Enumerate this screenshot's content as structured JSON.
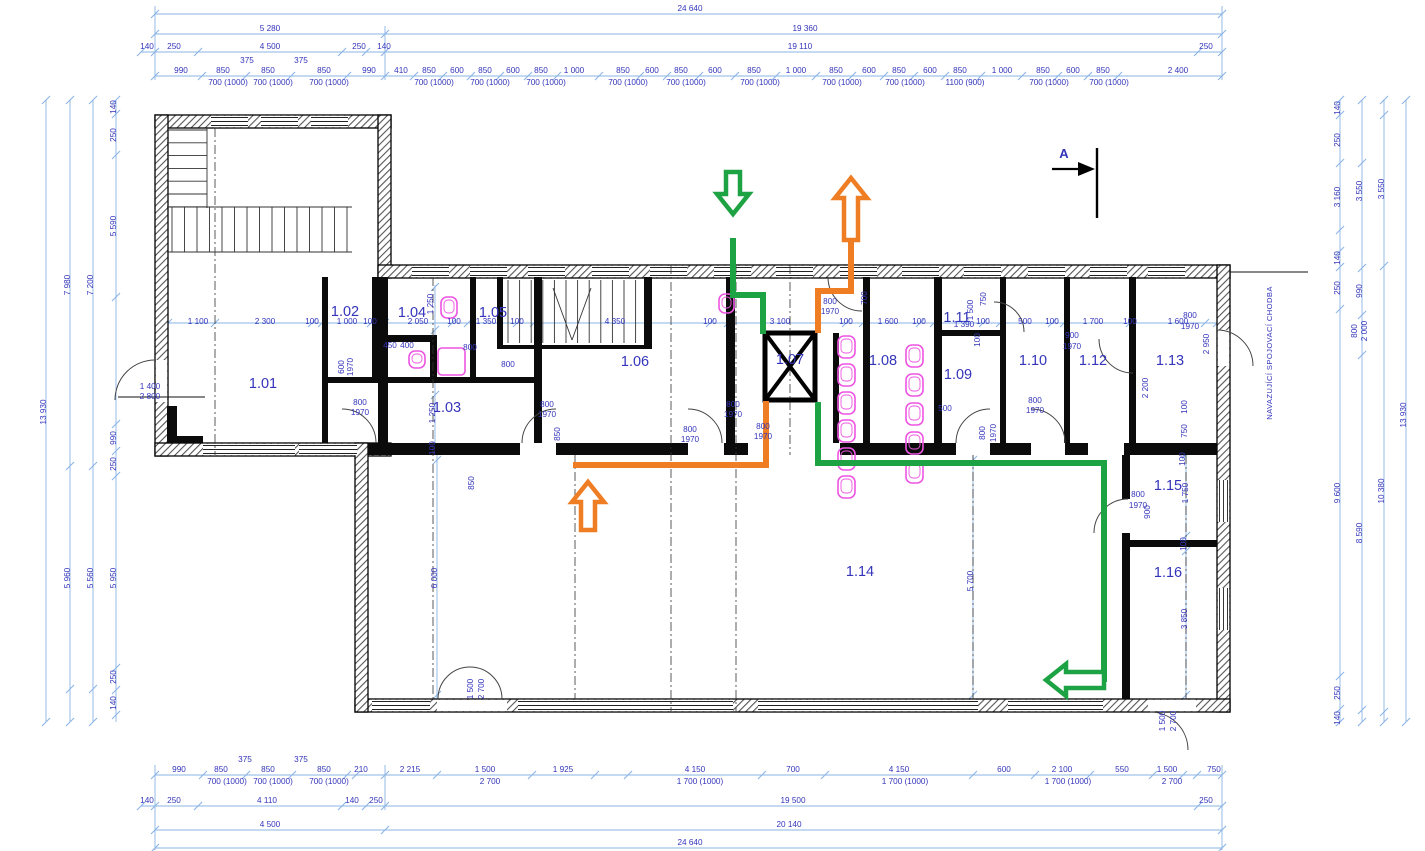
{
  "drawing": {
    "type": "architectural-floor-plan",
    "section_marker": "A",
    "corridor_note": "NAVAZUJÍCÍ SPOJOVACÍ CHODBA"
  },
  "colors": {
    "dim_line": "#8ab4e4",
    "dim_text": "#3434bb",
    "room_text": "#3434bb",
    "wall": "#000000",
    "fixture": "#ee55e2",
    "green": "#1da344",
    "orange": "#ee7d23"
  },
  "rooms": [
    {
      "id": "1.01",
      "x": 263,
      "y": 388
    },
    {
      "id": "1.02",
      "x": 345,
      "y": 316
    },
    {
      "id": "1.03",
      "x": 447,
      "y": 412
    },
    {
      "id": "1.04",
      "x": 412,
      "y": 317
    },
    {
      "id": "1.05",
      "x": 493,
      "y": 317
    },
    {
      "id": "1.06",
      "x": 635,
      "y": 366
    },
    {
      "id": "1.07",
      "x": 790,
      "y": 364
    },
    {
      "id": "1.08",
      "x": 883,
      "y": 365
    },
    {
      "id": "1.09",
      "x": 958,
      "y": 379
    },
    {
      "id": "1.10",
      "x": 1033,
      "y": 365
    },
    {
      "id": "1.11",
      "x": 957,
      "y": 322
    },
    {
      "id": "1.12",
      "x": 1093,
      "y": 365
    },
    {
      "id": "1.13",
      "x": 1170,
      "y": 365
    },
    {
      "id": "1.14",
      "x": 860,
      "y": 576
    },
    {
      "id": "1.15",
      "x": 1168,
      "y": 490
    },
    {
      "id": "1.16",
      "x": 1168,
      "y": 577
    }
  ],
  "labels": [
    {
      "t": "24 640",
      "x": 690,
      "y": 11
    },
    {
      "t": "5 280",
      "x": 270,
      "y": 31
    },
    {
      "t": "19 360",
      "x": 805,
      "y": 31
    },
    {
      "t": "140",
      "x": 147,
      "y": 49
    },
    {
      "t": "250",
      "x": 174,
      "y": 49
    },
    {
      "t": "4 500",
      "x": 270,
      "y": 49
    },
    {
      "t": "250",
      "x": 359,
      "y": 49
    },
    {
      "t": "140",
      "x": 384,
      "y": 49
    },
    {
      "t": "19 110",
      "x": 800,
      "y": 49
    },
    {
      "t": "250",
      "x": 1206,
      "y": 49
    },
    {
      "t": "375",
      "x": 247,
      "y": 63
    },
    {
      "t": "375",
      "x": 301,
      "y": 63
    },
    {
      "t": "990",
      "x": 181,
      "y": 73
    },
    {
      "t": "850",
      "x": 223,
      "y": 73
    },
    {
      "t": "850",
      "x": 268,
      "y": 73
    },
    {
      "t": "850",
      "x": 324,
      "y": 73
    },
    {
      "t": "990",
      "x": 369,
      "y": 73
    },
    {
      "t": "410",
      "x": 401,
      "y": 73
    },
    {
      "t": "850",
      "x": 429,
      "y": 73
    },
    {
      "t": "600",
      "x": 457,
      "y": 73
    },
    {
      "t": "850",
      "x": 485,
      "y": 73
    },
    {
      "t": "600",
      "x": 513,
      "y": 73
    },
    {
      "t": "850",
      "x": 541,
      "y": 73
    },
    {
      "t": "1 000",
      "x": 574,
      "y": 73
    },
    {
      "t": "850",
      "x": 623,
      "y": 73
    },
    {
      "t": "600",
      "x": 652,
      "y": 73
    },
    {
      "t": "850",
      "x": 681,
      "y": 73
    },
    {
      "t": "600",
      "x": 715,
      "y": 73
    },
    {
      "t": "850",
      "x": 754,
      "y": 73
    },
    {
      "t": "1 000",
      "x": 796,
      "y": 73
    },
    {
      "t": "850",
      "x": 836,
      "y": 73
    },
    {
      "t": "600",
      "x": 869,
      "y": 73
    },
    {
      "t": "850",
      "x": 899,
      "y": 73
    },
    {
      "t": "600",
      "x": 930,
      "y": 73
    },
    {
      "t": "850",
      "x": 960,
      "y": 73
    },
    {
      "t": "1 000",
      "x": 1002,
      "y": 73
    },
    {
      "t": "850",
      "x": 1043,
      "y": 73
    },
    {
      "t": "600",
      "x": 1073,
      "y": 73
    },
    {
      "t": "850",
      "x": 1103,
      "y": 73
    },
    {
      "t": "2 400",
      "x": 1178,
      "y": 73
    },
    {
      "t": "700 (1000)",
      "x": 228,
      "y": 85
    },
    {
      "t": "700 (1000)",
      "x": 273,
      "y": 85
    },
    {
      "t": "700 (1000)",
      "x": 329,
      "y": 85
    },
    {
      "t": "700 (1000)",
      "x": 434,
      "y": 85
    },
    {
      "t": "700 (1000)",
      "x": 490,
      "y": 85
    },
    {
      "t": "700 (1000)",
      "x": 546,
      "y": 85
    },
    {
      "t": "700 (1000)",
      "x": 628,
      "y": 85
    },
    {
      "t": "700 (1000)",
      "x": 686,
      "y": 85
    },
    {
      "t": "700 (1000)",
      "x": 760,
      "y": 85
    },
    {
      "t": "700 (1000)",
      "x": 842,
      "y": 85
    },
    {
      "t": "700 (1000)",
      "x": 905,
      "y": 85
    },
    {
      "t": "1100 (900)",
      "x": 965,
      "y": 85
    },
    {
      "t": "700 (1000)",
      "x": 1049,
      "y": 85
    },
    {
      "t": "700 (1000)",
      "x": 1109,
      "y": 85
    },
    {
      "t": "375",
      "x": 245,
      "y": 762
    },
    {
      "t": "375",
      "x": 301,
      "y": 762
    },
    {
      "t": "990",
      "x": 179,
      "y": 772
    },
    {
      "t": "850",
      "x": 221,
      "y": 772
    },
    {
      "t": "850",
      "x": 268,
      "y": 772
    },
    {
      "t": "850",
      "x": 324,
      "y": 772
    },
    {
      "t": "210",
      "x": 361,
      "y": 772
    },
    {
      "t": "2 215",
      "x": 410,
      "y": 772
    },
    {
      "t": "1 500",
      "x": 485,
      "y": 772
    },
    {
      "t": "1 925",
      "x": 563,
      "y": 772
    },
    {
      "t": "4 150",
      "x": 695,
      "y": 772
    },
    {
      "t": "700",
      "x": 793,
      "y": 772
    },
    {
      "t": "4 150",
      "x": 899,
      "y": 772
    },
    {
      "t": "600",
      "x": 1004,
      "y": 772
    },
    {
      "t": "2 100",
      "x": 1062,
      "y": 772
    },
    {
      "t": "550",
      "x": 1122,
      "y": 772
    },
    {
      "t": "1 500",
      "x": 1167,
      "y": 772
    },
    {
      "t": "750",
      "x": 1214,
      "y": 772
    },
    {
      "t": "700 (1000)",
      "x": 227,
      "y": 784
    },
    {
      "t": "700 (1000)",
      "x": 273,
      "y": 784
    },
    {
      "t": "700 (1000)",
      "x": 329,
      "y": 784
    },
    {
      "t": "2 700",
      "x": 490,
      "y": 784
    },
    {
      "t": "1 700 (1000)",
      "x": 700,
      "y": 784
    },
    {
      "t": "1 700 (1000)",
      "x": 905,
      "y": 784
    },
    {
      "t": "1 700 (1000)",
      "x": 1068,
      "y": 784
    },
    {
      "t": "2 700",
      "x": 1172,
      "y": 784
    },
    {
      "t": "140",
      "x": 147,
      "y": 803
    },
    {
      "t": "250",
      "x": 174,
      "y": 803
    },
    {
      "t": "4 110",
      "x": 267,
      "y": 803
    },
    {
      "t": "140",
      "x": 352,
      "y": 803
    },
    {
      "t": "250",
      "x": 376,
      "y": 803
    },
    {
      "t": "19 500",
      "x": 793,
      "y": 803
    },
    {
      "t": "250",
      "x": 1206,
      "y": 803
    },
    {
      "t": "4 500",
      "x": 270,
      "y": 827
    },
    {
      "t": "20 140",
      "x": 789,
      "y": 827
    },
    {
      "t": "24 640",
      "x": 690,
      "y": 845
    },
    {
      "t": "13 930",
      "x": 46,
      "y": 412,
      "r": -90
    },
    {
      "t": "7 980",
      "x": 70,
      "y": 285,
      "r": -90
    },
    {
      "t": "5 960",
      "x": 70,
      "y": 578,
      "r": -90
    },
    {
      "t": "7 200",
      "x": 93,
      "y": 285,
      "r": -90
    },
    {
      "t": "5 560",
      "x": 93,
      "y": 578,
      "r": -90
    },
    {
      "t": "140",
      "x": 116,
      "y": 107,
      "r": -90
    },
    {
      "t": "250",
      "x": 116,
      "y": 135,
      "r": -90
    },
    {
      "t": "5 590",
      "x": 116,
      "y": 226,
      "r": -90
    },
    {
      "t": "990",
      "x": 116,
      "y": 438,
      "r": -90
    },
    {
      "t": "250",
      "x": 116,
      "y": 464,
      "r": -90
    },
    {
      "t": "5 950",
      "x": 116,
      "y": 578,
      "r": -90
    },
    {
      "t": "250",
      "x": 116,
      "y": 677,
      "r": -90
    },
    {
      "t": "140",
      "x": 116,
      "y": 703,
      "r": -90
    },
    {
      "t": "1 400",
      "x": 150,
      "y": 389
    },
    {
      "t": "2 800",
      "x": 150,
      "y": 399
    },
    {
      "t": "140",
      "x": 1340,
      "y": 108,
      "r": -90
    },
    {
      "t": "250",
      "x": 1340,
      "y": 140,
      "r": -90
    },
    {
      "t": "3 160",
      "x": 1340,
      "y": 197,
      "r": -90
    },
    {
      "t": "140",
      "x": 1340,
      "y": 258,
      "r": -90
    },
    {
      "t": "250",
      "x": 1340,
      "y": 288,
      "r": -90
    },
    {
      "t": "9 600",
      "x": 1340,
      "y": 493,
      "r": -90
    },
    {
      "t": "250",
      "x": 1340,
      "y": 693,
      "r": -90
    },
    {
      "t": "140",
      "x": 1340,
      "y": 718,
      "r": -90
    },
    {
      "t": "3 550",
      "x": 1362,
      "y": 191,
      "r": -90
    },
    {
      "t": "990",
      "x": 1362,
      "y": 291,
      "r": -90
    },
    {
      "t": "800",
      "x": 1357,
      "y": 331,
      "r": -90
    },
    {
      "t": "2 000",
      "x": 1367,
      "y": 331,
      "r": -90
    },
    {
      "t": "8 590",
      "x": 1362,
      "y": 533,
      "r": -90
    },
    {
      "t": "3 550",
      "x": 1384,
      "y": 189,
      "r": -90
    },
    {
      "t": "10 380",
      "x": 1384,
      "y": 491,
      "r": -90
    },
    {
      "t": "13 930",
      "x": 1406,
      "y": 415,
      "r": -90
    },
    {
      "t": "1 100",
      "x": 198,
      "y": 324
    },
    {
      "t": "2 300",
      "x": 265,
      "y": 324
    },
    {
      "t": "100",
      "x": 312,
      "y": 324
    },
    {
      "t": "1 000",
      "x": 347,
      "y": 324
    },
    {
      "t": "100",
      "x": 370,
      "y": 324
    },
    {
      "t": "2 050",
      "x": 418,
      "y": 324
    },
    {
      "t": "100",
      "x": 454,
      "y": 324
    },
    {
      "t": "1 350",
      "x": 486,
      "y": 324
    },
    {
      "t": "100",
      "x": 517,
      "y": 324
    },
    {
      "t": "4 350",
      "x": 615,
      "y": 324
    },
    {
      "t": "100",
      "x": 710,
      "y": 324
    },
    {
      "t": "3 100",
      "x": 780,
      "y": 324
    },
    {
      "t": "100",
      "x": 846,
      "y": 324
    },
    {
      "t": "1 600",
      "x": 888,
      "y": 324
    },
    {
      "t": "100",
      "x": 919,
      "y": 324
    },
    {
      "t": "1 390",
      "x": 964,
      "y": 327
    },
    {
      "t": "100",
      "x": 983,
      "y": 324
    },
    {
      "t": "500",
      "x": 1025,
      "y": 324
    },
    {
      "t": "100",
      "x": 1052,
      "y": 324
    },
    {
      "t": "1 700",
      "x": 1093,
      "y": 324
    },
    {
      "t": "100",
      "x": 1130,
      "y": 324
    },
    {
      "t": "1 600",
      "x": 1178,
      "y": 324
    },
    {
      "t": "1 250",
      "x": 433,
      "y": 304,
      "r": -90
    },
    {
      "t": "1 250",
      "x": 435,
      "y": 413,
      "r": -90
    },
    {
      "t": "100",
      "x": 435,
      "y": 448,
      "r": -90
    },
    {
      "t": "850",
      "x": 474,
      "y": 483,
      "r": -90
    },
    {
      "t": "600",
      "x": 344,
      "y": 367,
      "r": -90
    },
    {
      "t": "1970",
      "x": 353,
      "y": 367,
      "r": -90
    },
    {
      "t": "700",
      "x": 867,
      "y": 298,
      "r": -90
    },
    {
      "t": "750",
      "x": 986,
      "y": 299,
      "r": -90
    },
    {
      "t": "1 500",
      "x": 973,
      "y": 310,
      "r": -90
    },
    {
      "t": "100",
      "x": 980,
      "y": 340,
      "r": -90
    },
    {
      "t": "2 200",
      "x": 1148,
      "y": 388,
      "r": -90
    },
    {
      "t": "2 950",
      "x": 1209,
      "y": 344,
      "r": -90
    },
    {
      "t": "100",
      "x": 1187,
      "y": 407,
      "r": -90
    },
    {
      "t": "750",
      "x": 1187,
      "y": 431,
      "r": -90
    },
    {
      "t": "100",
      "x": 1185,
      "y": 459,
      "r": -90
    },
    {
      "t": "1 750",
      "x": 1188,
      "y": 493,
      "r": -90
    },
    {
      "t": "100",
      "x": 1186,
      "y": 544,
      "r": -90
    },
    {
      "t": "3 850",
      "x": 1187,
      "y": 619,
      "r": -90
    },
    {
      "t": "6 000",
      "x": 437,
      "y": 578,
      "r": -90
    },
    {
      "t": "5 700",
      "x": 973,
      "y": 581,
      "r": -90
    },
    {
      "t": "850",
      "x": 560,
      "y": 434,
      "r": -90
    },
    {
      "t": "800",
      "x": 985,
      "y": 433,
      "r": -90
    },
    {
      "t": "1970",
      "x": 996,
      "y": 433,
      "r": -90
    },
    {
      "t": "900",
      "x": 1150,
      "y": 512,
      "r": -90
    },
    {
      "t": "1 500",
      "x": 473,
      "y": 689,
      "r": -90
    },
    {
      "t": "2 700",
      "x": 484,
      "y": 689,
      "r": -90
    },
    {
      "t": "1 500",
      "x": 1165,
      "y": 721,
      "r": -90
    },
    {
      "t": "2 700",
      "x": 1176,
      "y": 721,
      "r": -90
    },
    {
      "t": "800",
      "x": 360,
      "y": 405
    },
    {
      "t": "1970",
      "x": 360,
      "y": 415
    },
    {
      "t": "800",
      "x": 547,
      "y": 407
    },
    {
      "t": "1970",
      "x": 547,
      "y": 417
    },
    {
      "t": "800",
      "x": 733,
      "y": 407
    },
    {
      "t": "1970",
      "x": 733,
      "y": 417
    },
    {
      "t": "800",
      "x": 690,
      "y": 432
    },
    {
      "t": "1970",
      "x": 690,
      "y": 442
    },
    {
      "t": "800",
      "x": 763,
      "y": 429
    },
    {
      "t": "1970",
      "x": 763,
      "y": 439
    },
    {
      "t": "800",
      "x": 830,
      "y": 304
    },
    {
      "t": "1970",
      "x": 830,
      "y": 314
    },
    {
      "t": "900",
      "x": 1072,
      "y": 338
    },
    {
      "t": "1970",
      "x": 1072,
      "y": 349
    },
    {
      "t": "800",
      "x": 1190,
      "y": 318
    },
    {
      "t": "1970",
      "x": 1190,
      "y": 329
    },
    {
      "t": "800",
      "x": 1035,
      "y": 403
    },
    {
      "t": "1970",
      "x": 1035,
      "y": 413
    },
    {
      "t": "500",
      "x": 945,
      "y": 411
    },
    {
      "t": "800",
      "x": 1138,
      "y": 497
    },
    {
      "t": "1970",
      "x": 1138,
      "y": 508
    },
    {
      "t": "450",
      "x": 390,
      "y": 348
    },
    {
      "t": "400",
      "x": 407,
      "y": 348
    },
    {
      "t": "800",
      "x": 470,
      "y": 350
    },
    {
      "t": "800",
      "x": 508,
      "y": 367
    }
  ],
  "routes": [
    {
      "name": "green-route-entry",
      "color": "green",
      "points": [
        [
          733,
          238
        ],
        [
          733,
          295
        ],
        [
          763,
          295
        ],
        [
          763,
          334
        ]
      ]
    },
    {
      "name": "green-route-exit",
      "color": "green",
      "points": [
        [
          818,
          402
        ],
        [
          818,
          463
        ],
        [
          1104,
          463
        ],
        [
          1104,
          682
        ]
      ]
    },
    {
      "name": "orange-route-upper",
      "color": "orange",
      "points": [
        [
          851,
          242
        ],
        [
          851,
          291
        ],
        [
          818,
          291
        ],
        [
          818,
          333
        ]
      ]
    },
    {
      "name": "orange-route-lower",
      "color": "orange",
      "points": [
        [
          766,
          401
        ],
        [
          766,
          465
        ],
        [
          573,
          465
        ]
      ]
    }
  ],
  "arrows": [
    {
      "name": "entry-arrow-green-down",
      "color": "green",
      "points": "726,172 740,172 740,194 749,194 733,214 717,194 726,194"
    },
    {
      "name": "exit-arrow-orange-up",
      "color": "orange",
      "points": "851,178 867,198 858,198 858,240 844,240 844,198 835,198"
    },
    {
      "name": "route-arrow-orange-up",
      "color": "orange",
      "points": "588,482 604,502 595,502 595,530 581,530 581,502 572,502"
    },
    {
      "name": "route-arrow-green-left",
      "color": "green",
      "points": "1046,680 1066,664 1066,672 1104,672 1104,688 1066,688 1066,696"
    }
  ]
}
